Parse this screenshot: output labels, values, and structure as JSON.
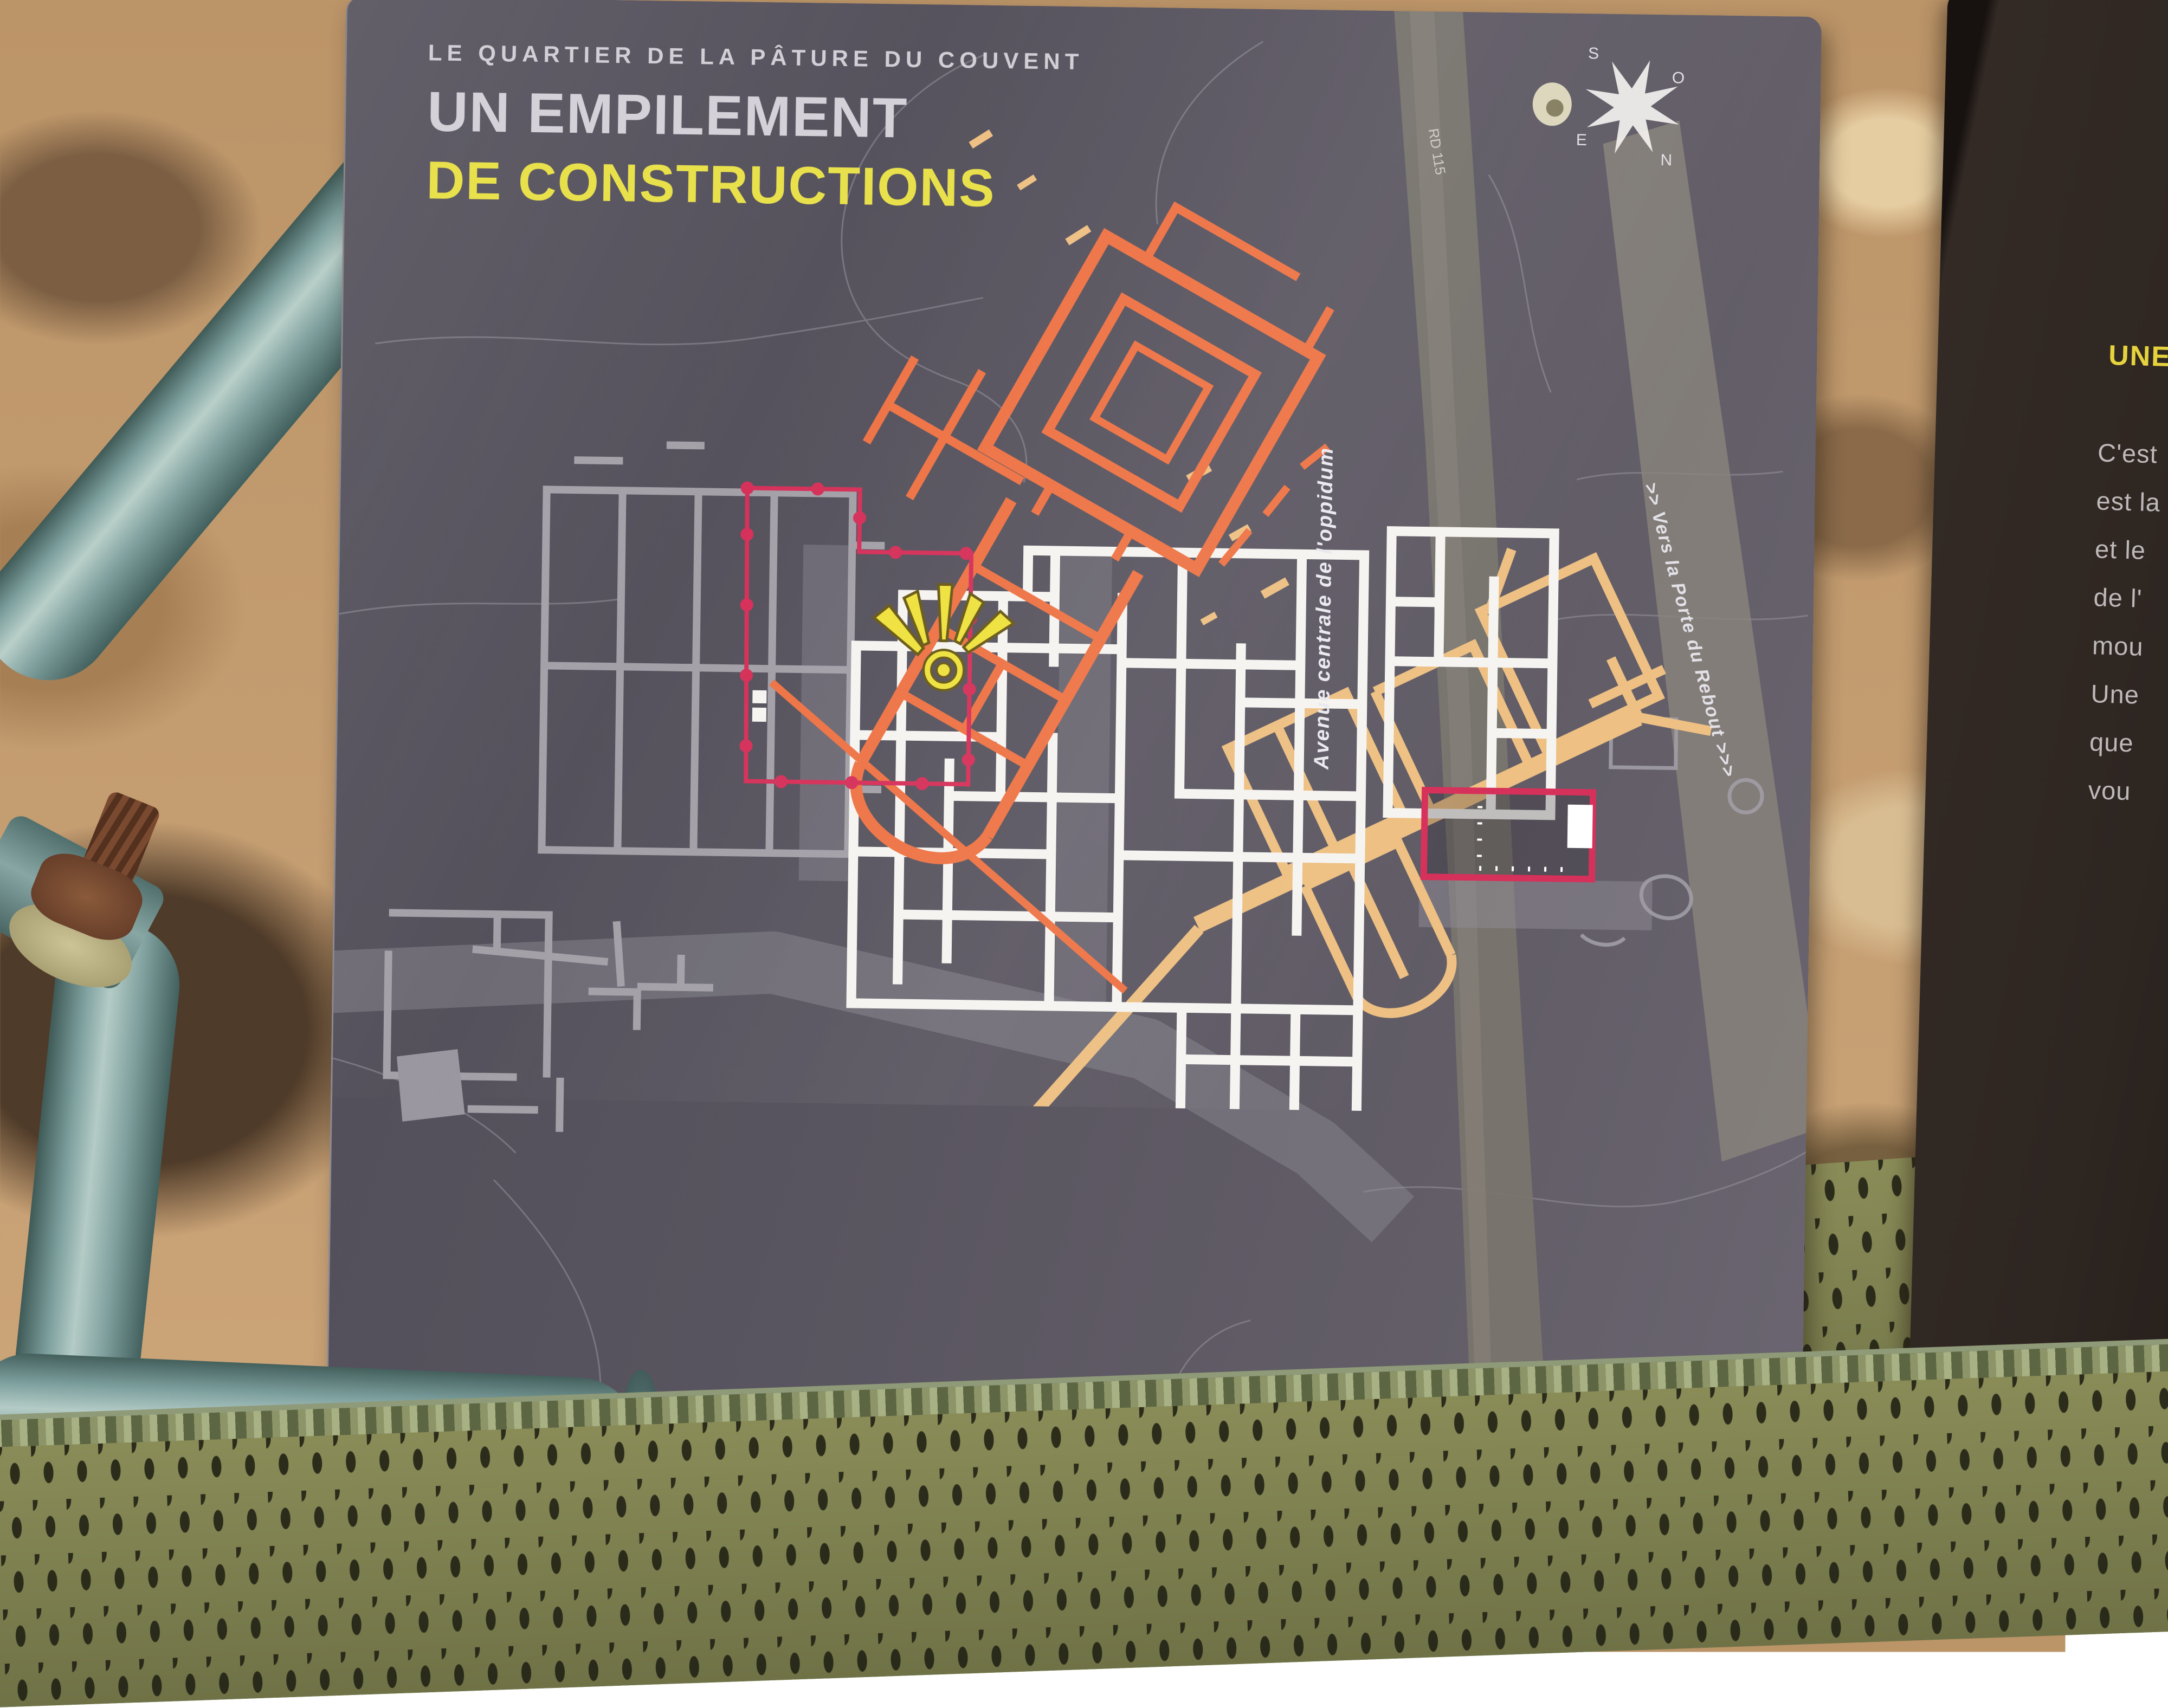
{
  "sign": {
    "kicker": "LE QUARTIER DE LA PÂTURE DU COUVENT",
    "title_line1": "UN EMPILEMENT",
    "title_line2": "DE CONSTRUCTIONS"
  },
  "map": {
    "labels": {
      "avenue": "Avenue centrale de l'oppidum",
      "rebout": ">>   Vers la Porte du Rebout   >>>",
      "road": "RD 115",
      "bassin": "Bassin"
    },
    "marker": "sunburst-you-are-here",
    "compass": {
      "n": "N",
      "s": "S",
      "e": "E",
      "o": "O"
    },
    "scale": {
      "start": "0",
      "end": "20 m"
    }
  },
  "legend": {
    "items": [
      {
        "label": "Vestiges médiévaux visibles",
        "color": "#ee7446"
      },
      {
        "label": "Vestiges médiévaux non visibles",
        "color": "#eec083"
      },
      {
        "label": "Vestiges antiques visibles",
        "color": "#ffffff"
      },
      {
        "label": "Vestiges antiques non visibles",
        "color": "#8d8a94"
      },
      {
        "label": "Abri de protection des vestiges",
        "color": "#b9b6bf",
        "border": "#d6315a"
      }
    ]
  },
  "side_panel": {
    "title": "UNE",
    "lines": [
      "C'est",
      "est la",
      "et le",
      "de l'",
      "mou",
      "Une",
      "que",
      "vou"
    ]
  },
  "colors": {
    "panel_background": "#58545f",
    "medieval_visible": "#ee7446",
    "medieval_hidden": "#eec083",
    "antique_visible": "#f6f4f0",
    "antique_hidden": "#8d8a94",
    "shelter_outline": "#d6315a",
    "highlight_yellow": "#e9e14b",
    "marker_yellow": "#efe23e"
  }
}
